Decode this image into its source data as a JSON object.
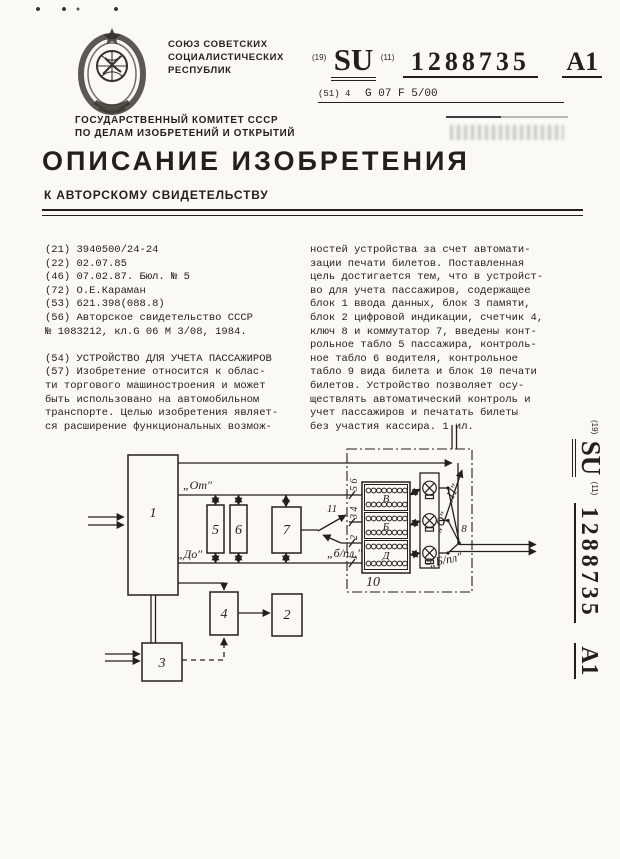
{
  "header": {
    "country": [
      "СОЮЗ СОВЕТСКИХ",
      "СОЦИАЛИСТИЧЕСКИХ",
      "РЕСПУБЛИК"
    ],
    "committee": [
      "ГОСУДАРСТВЕННЫЙ КОМИТЕТ СССР",
      "ПО ДЕЛАМ ИЗОБРЕТЕНИЙ И ОТКРЫТИЙ"
    ],
    "code_19": "(19)",
    "su": "SU",
    "code_11": "(11)",
    "doc_number": "1288735",
    "kind": "A1",
    "ipc_prefix": "(51) 4",
    "ipc_code": "G 07 F 5/00"
  },
  "title": {
    "main": "ОПИСАНИЕ ИЗОБРЕТЕНИЯ",
    "sub": "К АВТОРСКОМУ СВИДЕТЕЛЬСТВУ"
  },
  "left_column": [
    "(21) 3940500/24-24",
    "(22) 02.07.85",
    "(46) 07.02.87. Бюл. № 5",
    "(72) О.Е.Караман",
    "(53) 621.398(088.8)",
    "(56) Авторское свидетельство СССР",
    "№ 1083212, кл.G 06 M 3/08, 1984.",
    "",
    "(54) УСТРОЙСТВО ДЛЯ УЧЕТА ПАССАЖИРОВ",
    "(57) Изобретение относится к облас-",
    "ти торгового машиностроения и может",
    "быть использовано на автомобильном",
    "транспорте. Целью изобретения являет-",
    "ся расширение функциональных возмож-"
  ],
  "right_column": [
    "ностей устройства за счет автомати-",
    "зации печати билетов. Поставленная",
    "цель достигается тем, что в устройст-",
    "во для учета пассажиров, содержащее",
    "блок 1 ввода данных, блок 3 памяти,",
    "блок 2 цифровой индикации, счетчик 4,",
    "ключ 8 и коммутатор 7, введены конт-",
    "рольное табло 5 пассажира, контроль-",
    "ное табло 6 водителя, контрольное",
    "табло 9 вида билета и блок 10 печати",
    "билетов. Устройство позволяет осу-",
    "ществлять автоматический контроль и",
    "учет пассажиров и печатать билеты",
    "без участия кассира. 1 ил."
  ],
  "sidebar": {
    "code_19": "(19)",
    "su": "SU",
    "code_11": "(11)",
    "doc_number": "1288735",
    "kind": "A1"
  },
  "diagram": {
    "block_labels": {
      "input": "1",
      "indicator": "2",
      "memory": "3",
      "counter": "4",
      "pass_board": "5",
      "driver_board": "6",
      "commutator": "7",
      "key": "8",
      "type_board": "9",
      "printer": "10",
      "switch": "11"
    },
    "wire_labels": {
      "from": "„От″",
      "to": "„До″",
      "switch_bpl": "„б/пл.″",
      "type_p": "„П″",
      "type_o": "„О″",
      "type_bpl": "„Б/пл″"
    },
    "printer_letters": [
      "В",
      "Б",
      "Д"
    ],
    "wire_numbers": {
      "top": "5 6",
      "middle": "3 4",
      "second": "2",
      "bottom": "1"
    }
  }
}
